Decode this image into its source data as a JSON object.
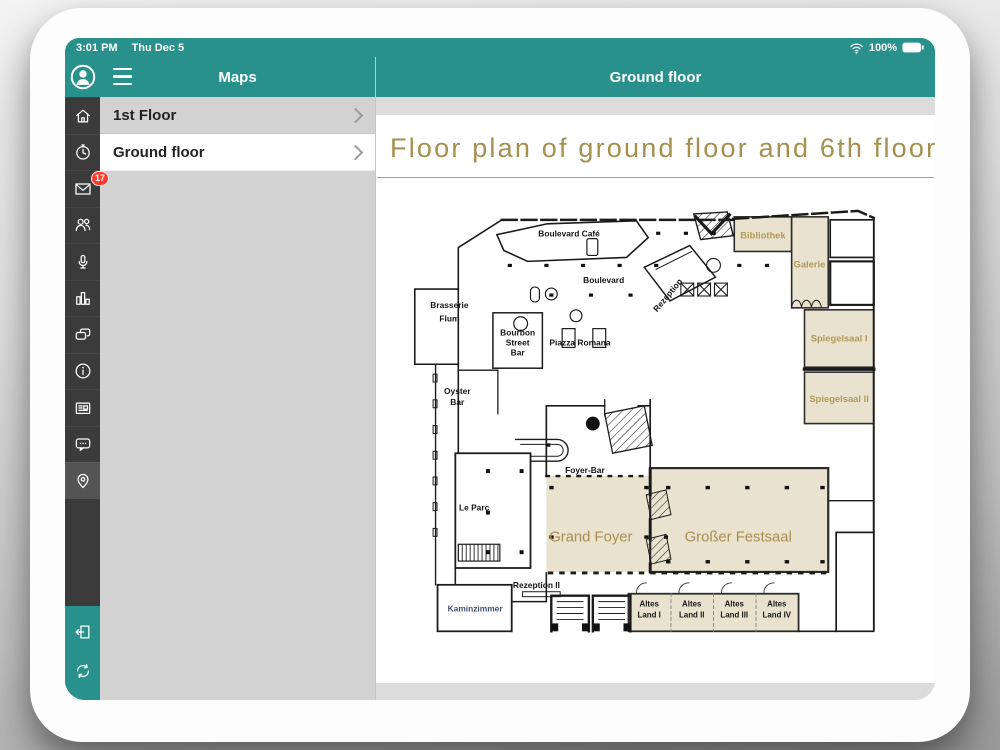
{
  "colors": {
    "accent": "#28918c",
    "gold_title": "#a6904e",
    "tan_room": "#e9e2cf",
    "room_label_tan": "#b3995a",
    "badge_red": "#ff3b30",
    "sidebar_dark": "#3b3b3b"
  },
  "status_bar": {
    "time": "3:01 PM",
    "date": "Thu Dec 5",
    "battery_percent": "100%"
  },
  "sidebar": {
    "mail_badge": "17",
    "active_item": "maps",
    "icons": [
      "profile",
      "home",
      "schedule",
      "mail",
      "attendees",
      "microphone",
      "statistics",
      "conversations",
      "info",
      "news",
      "messages",
      "maps",
      "logout",
      "refresh"
    ]
  },
  "maps_panel": {
    "title": "Maps",
    "items": [
      "1st Floor",
      "Ground floor"
    ],
    "selected": "Ground floor"
  },
  "content_header": {
    "title": "Ground floor"
  },
  "page": {
    "title": "Floor plan of ground floor and 6th floor"
  },
  "floor_plan": {
    "boulevard_cafe": "Boulevard Café",
    "boulevard": "Boulevard",
    "brasserie_flum": [
      "Brasserie",
      "Flum"
    ],
    "bourbon_street_bar": [
      "Bourbon",
      "Street",
      "Bar"
    ],
    "piazza_romana": "Piazza Romana",
    "rezeption": "Rezeption",
    "bibliothek": "Bibliothek",
    "galerie": "Galerie",
    "spiegelsaal_1": "Spiegelsaal I",
    "spiegelsaal_2": "Spiegelsaal II",
    "oyster_bar": [
      "Oyster",
      "Bar"
    ],
    "foyer_bar": "Foyer-Bar",
    "le_parc": "Le Parc",
    "grand_foyer": "Grand Foyer",
    "grosser_festsaal": "Großer Festsaal",
    "rezeption_2": "Rezeption II",
    "kaminzimmer": "Kaminzimmer",
    "altes_land": [
      [
        "Altes",
        "Land I"
      ],
      [
        "Altes",
        "Land II"
      ],
      [
        "Altes",
        "Land III"
      ],
      [
        "Altes",
        "Land IV"
      ]
    ]
  }
}
